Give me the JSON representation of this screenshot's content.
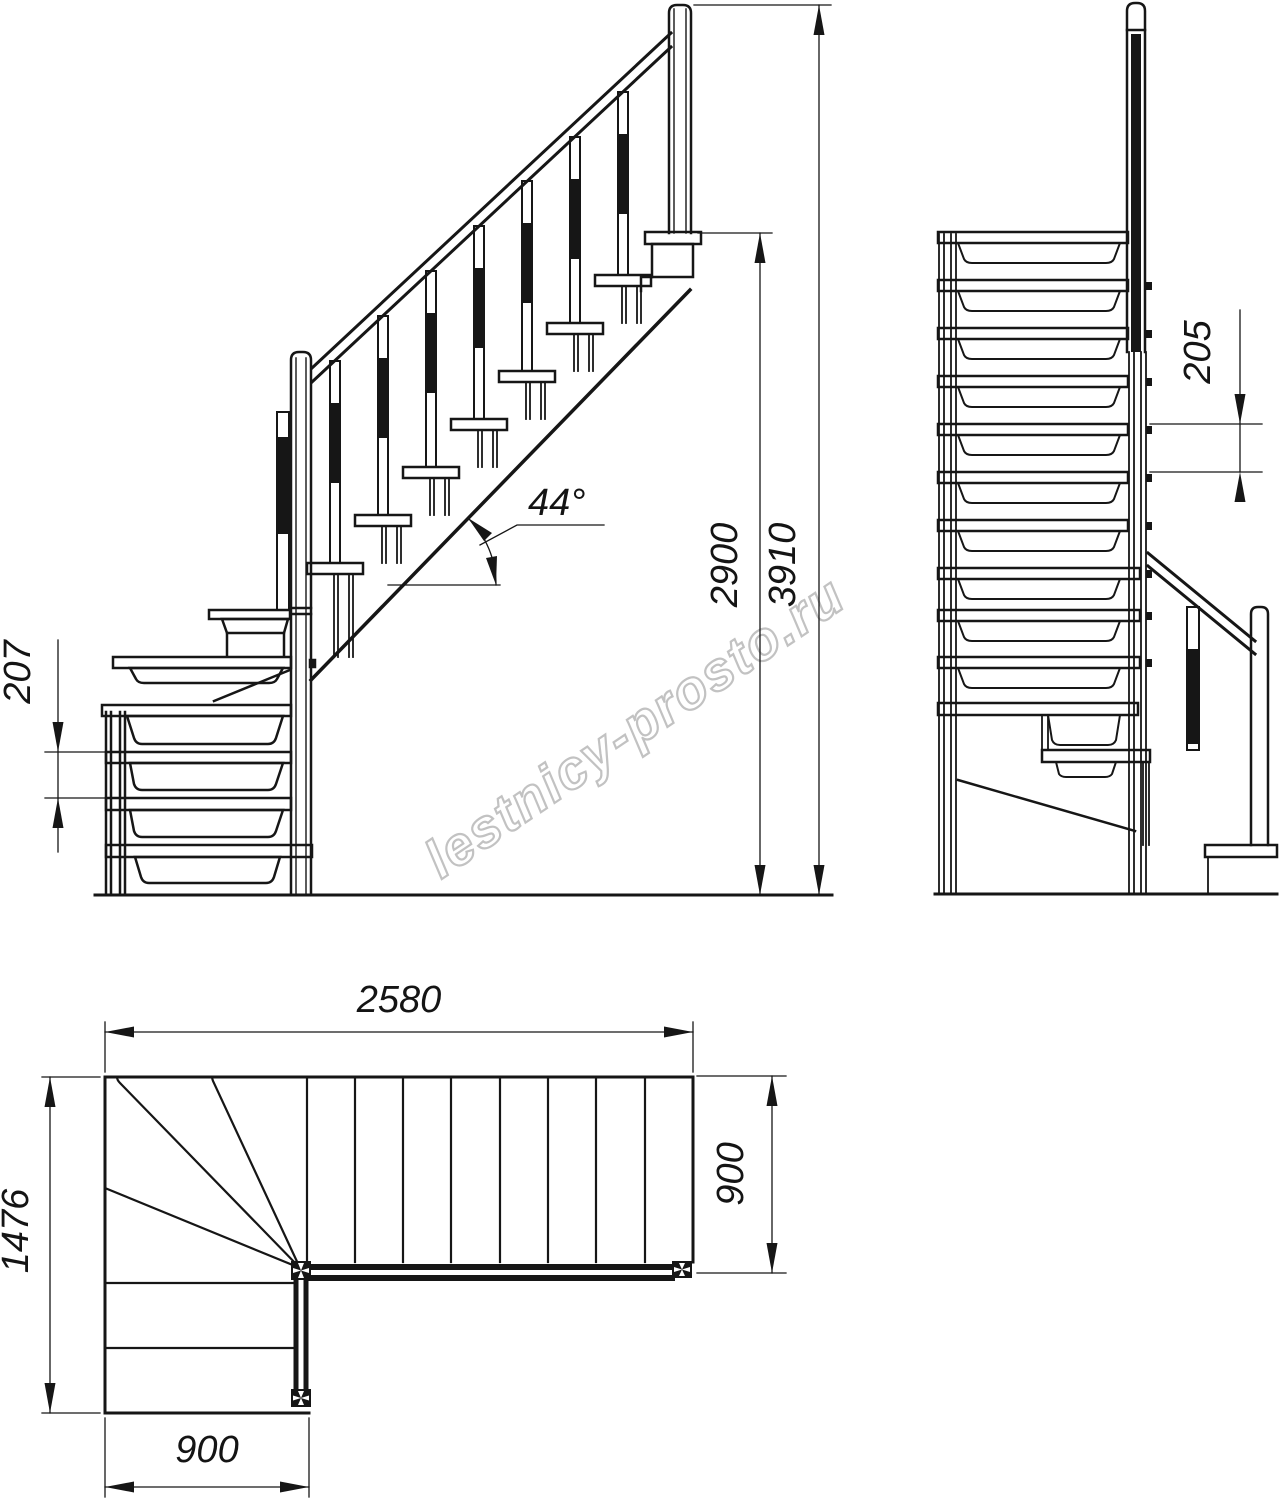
{
  "drawing": {
    "type": "staircase-blueprint",
    "line_color": "#161616",
    "watermark_color": "#c2c2c2"
  },
  "watermark": {
    "text": "lestnicy-prosto.ru"
  },
  "dimensions": {
    "side": {
      "riser_height": "207",
      "angle": "44°",
      "floor_height": "2900",
      "total_height": "3910"
    },
    "front": {
      "riser_height": "205"
    },
    "plan": {
      "total_run": "2580",
      "total_width": "1476",
      "lower_flight_width": "900",
      "upper_flight_width": "900"
    }
  }
}
